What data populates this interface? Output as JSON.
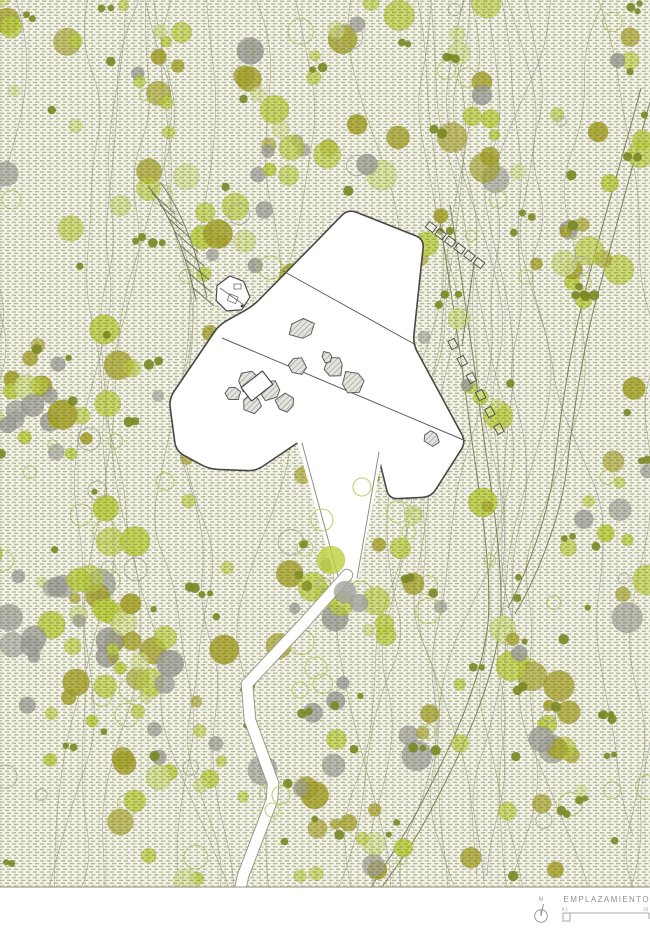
{
  "title": {
    "label": "EMPLAZAMIENTO"
  },
  "legend": {
    "north_label": "N",
    "scale_left": "0 1",
    "scale_right": "10"
  },
  "palette": {
    "page_bg": "#ffffff",
    "map_base": "#f4f4e9",
    "hatch_dash": "#6f7240",
    "contour_olive": "#a9ac82",
    "contour_gray": "#9aa0a2",
    "tree_chartreuse": "#bfd23f",
    "tree_pale": "#d8e393",
    "tree_olive": "#a9a528",
    "tree_darkdot": "#7e8c22",
    "tree_gray": "#a3a3a3",
    "tree_outline": "#b9cc66",
    "site_stroke": "#474747",
    "rock_stroke": "#5f5f5f",
    "rock_hatch": "#8d8d8d",
    "road_stroke": "#7b7e52",
    "path_casing": "#9a9a8e",
    "legend_text": "#8f8f8f"
  },
  "map": {
    "width": 650,
    "height": 888
  },
  "generation": {
    "seed": 20240613,
    "canopy_count": 330,
    "dot_pairs": 38,
    "dot_singles": 60,
    "outline_count": 72,
    "contour_count": 28
  },
  "site_outline": [
    [
      348,
      209
    ],
    [
      424,
      239
    ],
    [
      413,
      344
    ],
    [
      466,
      442
    ],
    [
      431,
      497
    ],
    [
      389,
      499
    ],
    [
      378,
      455
    ],
    [
      368,
      426
    ],
    [
      341,
      431
    ],
    [
      300,
      441
    ],
    [
      256,
      471
    ],
    [
      209,
      469
    ],
    [
      176,
      451
    ],
    [
      169,
      399
    ],
    [
      219,
      325
    ],
    [
      253,
      306
    ],
    [
      311,
      247
    ]
  ],
  "site_lines": [
    [
      283,
      271,
      416,
      345
    ],
    [
      222,
      338,
      466,
      441
    ]
  ],
  "wedge": {
    "fill": [
      [
        296,
        438
      ],
      [
        372,
        422
      ],
      [
        382,
        458
      ],
      [
        358,
        580
      ],
      [
        335,
        579
      ]
    ],
    "left_edge": [
      [
        302,
        443
      ],
      [
        338,
        576
      ]
    ],
    "right_edge": [
      [
        379,
        452
      ],
      [
        357,
        578
      ]
    ]
  },
  "walk_path": [
    [
      347,
      575
    ],
    [
      305,
      622
    ],
    [
      247,
      684
    ],
    [
      250,
      720
    ],
    [
      273,
      783
    ],
    [
      272,
      800
    ],
    [
      243,
      876
    ],
    [
      240,
      890
    ]
  ],
  "rocks": [
    [
      302,
      329,
      12
    ],
    [
      297,
      367,
      9
    ],
    [
      334,
      367,
      10
    ],
    [
      352,
      383,
      12
    ],
    [
      327,
      357,
      6
    ],
    [
      248,
      381,
      12
    ],
    [
      270,
      391,
      12
    ],
    [
      285,
      403,
      9
    ],
    [
      252,
      404,
      9
    ],
    [
      233,
      393,
      8
    ],
    [
      431,
      438,
      9
    ]
  ],
  "hut": {
    "cx": 233,
    "cy": 294,
    "r": 18
  },
  "cabin": {
    "cx": 257,
    "cy": 386,
    "w": 27,
    "h": 17,
    "angle": -38
  },
  "stairs": [
    {
      "x1": 431,
      "y1": 227,
      "x2": 479,
      "y2": 263,
      "n": 6
    },
    {
      "x1": 453,
      "y1": 344,
      "x2": 499,
      "y2": 429,
      "n": 6
    }
  ],
  "overlay_outline": [
    [
      322,
      520,
      11
    ],
    [
      305,
      548,
      8
    ],
    [
      398,
      512,
      11
    ],
    [
      409,
      532,
      7
    ],
    [
      362,
      487,
      9
    ],
    [
      316,
      668,
      11
    ],
    [
      300,
      690,
      8
    ],
    [
      281,
      795,
      9
    ],
    [
      272,
      810,
      7
    ]
  ],
  "overlay_fill": [
    [
      331,
      560,
      14,
      "chartreuse"
    ],
    [
      345,
      592,
      11,
      "gray"
    ],
    [
      359,
      603,
      9,
      "gray"
    ],
    [
      307,
      586,
      5,
      "darkdot"
    ],
    [
      299,
      575,
      4,
      "darkdot"
    ]
  ]
}
